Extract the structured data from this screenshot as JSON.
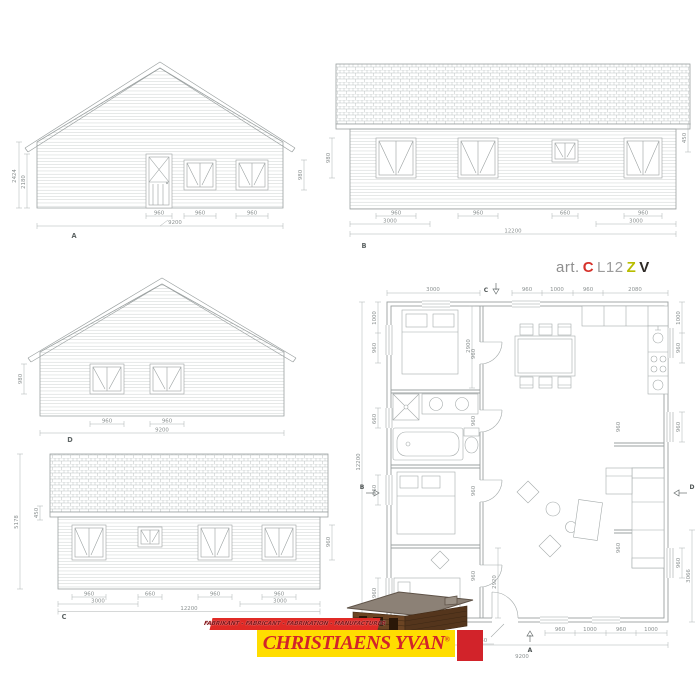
{
  "art": {
    "prefix": "art.",
    "code_c": "C",
    "code_l": "L12",
    "code_z": "Z",
    "code_v": "V"
  },
  "colors": {
    "line": "#9ba1a1",
    "dim_text": "#8b9191",
    "art_red": "#d6322b",
    "art_olive": "#b8bd00",
    "art_dark": "#2e2a26",
    "logo_red": "#d2232a",
    "logo_yellow": "#ffdd00"
  },
  "elev_a": {
    "label": "A",
    "dim_left_outer": "2424",
    "dim_left_inner": "2180",
    "dim_right": "980",
    "dim_door": "960",
    "dim_win1": "960",
    "dim_win2": "960",
    "dim_total": "9200"
  },
  "elev_b": {
    "label": "B",
    "dim_left": "980",
    "dim_right": "450",
    "dim_w1": "960",
    "dim_w1_area": "3000",
    "dim_w2": "960",
    "dim_w3": "660",
    "dim_w4": "960",
    "dim_w4_area": "3000",
    "dim_total": "12200"
  },
  "elev_d": {
    "label": "D",
    "dim_left": "980",
    "dim_w1": "960",
    "dim_w2": "960",
    "dim_total": "9200"
  },
  "elev_c": {
    "label": "C",
    "dim_height": "5178",
    "dim_eave": "450",
    "dim_right": "960",
    "dim_w1": "960",
    "dim_w1_area": "3000",
    "dim_w2": "660",
    "dim_w3": "960",
    "dim_w4": "960",
    "dim_w4_area": "3000",
    "dim_total": "12200"
  },
  "plan": {
    "marker_top": "C",
    "marker_left": "B",
    "marker_right": "D",
    "marker_bottom": "A",
    "top_d1": "3000",
    "top_d2": "960",
    "top_d3": "1000",
    "top_d4": "960",
    "top_d5": "2080",
    "left_d1": "1000",
    "left_d2": "960",
    "left_d3": "660",
    "left_d4": "960",
    "left_d5": "960",
    "left_total": "12200",
    "right_d1": "1000",
    "right_d2": "960",
    "right_d3": "960",
    "right_d4": "960",
    "right_d5": "3066",
    "bottom_door": "960",
    "bottom_d1": "960",
    "bottom_d2": "1000",
    "bottom_d3": "960",
    "bottom_d4": "1000",
    "bottom_total": "9200",
    "int_bed1": "2900",
    "int_bed3": "2920",
    "int_door1": "960",
    "int_door2": "960",
    "int_door3": "960",
    "int_door4": "960",
    "int_liv1": "960",
    "int_liv2": "960"
  },
  "logo": {
    "tagline": "FABRIKANT - FABRICANT - FABRIKATION - MANUFACTURER",
    "name": "CHRISTIAENS YVAN",
    "reg": "®"
  }
}
